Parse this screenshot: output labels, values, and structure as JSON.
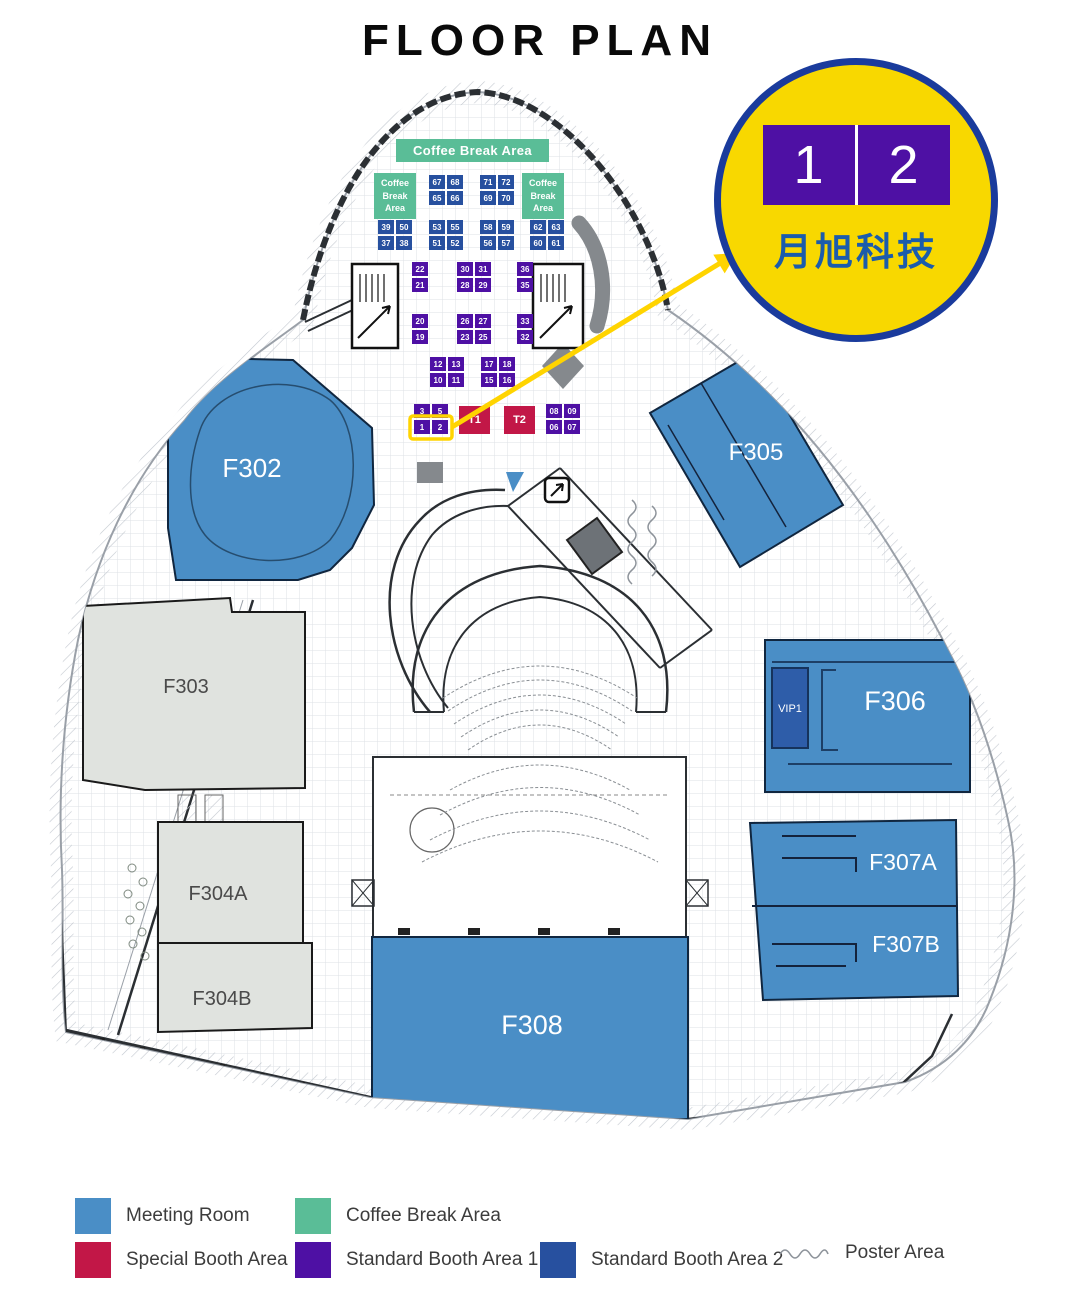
{
  "title": "FLOOR PLAN",
  "badge": {
    "left": "1",
    "right": "2",
    "company": "月旭科技"
  },
  "colors": {
    "meeting": "#4a8ec6",
    "coffee": "#5abd97",
    "special": "#c21747",
    "std1": "#4e10a4",
    "std2": "#27509f",
    "vip": "#2e5da9",
    "room_gray": "#e0e3df",
    "highlight": "#ffd400",
    "badge_bg": "#f8d800",
    "badge_border": "#1a3b9c",
    "badge_text": "#1b5cac",
    "poster": "#8d939a"
  },
  "floor": {
    "coffee_banner": "Coffee Break Area",
    "rooms": {
      "f302": "F302",
      "f303": "F303",
      "f304a": "F304A",
      "f304b": "F304B",
      "f305": "F305",
      "f306": "F306",
      "f307a": "F307A",
      "f307b": "F307B",
      "f308": "F308",
      "vip1": "VIP1"
    },
    "booth_clusters": [
      {
        "name": "cluster-65-68",
        "type": "std2",
        "x": 429,
        "y": 175,
        "rows": [
          [
            "67",
            "68"
          ],
          [
            "65",
            "66"
          ]
        ]
      },
      {
        "name": "cluster-69-72",
        "type": "std2",
        "x": 480,
        "y": 175,
        "rows": [
          [
            "71",
            "72"
          ],
          [
            "69",
            "70"
          ]
        ]
      },
      {
        "name": "coffee-area-left",
        "type": "coffee",
        "x": 374,
        "y": 173,
        "w": 42,
        "h": 46,
        "label": "Coffee Break Area"
      },
      {
        "name": "coffee-area-right",
        "type": "coffee",
        "x": 522,
        "y": 173,
        "w": 42,
        "h": 46,
        "label": "Coffee Break Area"
      },
      {
        "name": "cluster-37-50",
        "type": "std2",
        "x": 378,
        "y": 220,
        "rows": [
          [
            "39",
            "50"
          ],
          [
            "37",
            "38"
          ]
        ]
      },
      {
        "name": "cluster-51-55",
        "type": "std2",
        "x": 429,
        "y": 220,
        "rows": [
          [
            "53",
            "55"
          ],
          [
            "51",
            "52"
          ]
        ]
      },
      {
        "name": "cluster-56-59",
        "type": "std2",
        "x": 480,
        "y": 220,
        "rows": [
          [
            "58",
            "59"
          ],
          [
            "56",
            "57"
          ]
        ]
      },
      {
        "name": "cluster-60-63",
        "type": "std2",
        "x": 530,
        "y": 220,
        "rows": [
          [
            "62",
            "63"
          ],
          [
            "60",
            "61"
          ]
        ]
      },
      {
        "name": "cluster-21-22",
        "type": "std1",
        "x": 412,
        "y": 262,
        "rows": [
          [
            "22"
          ],
          [
            "21"
          ]
        ]
      },
      {
        "name": "cluster-28-31",
        "type": "std1",
        "x": 457,
        "y": 262,
        "rows": [
          [
            "30",
            "31"
          ],
          [
            "28",
            "29"
          ]
        ]
      },
      {
        "name": "cluster-35-36",
        "type": "std1",
        "x": 517,
        "y": 262,
        "rows": [
          [
            "36"
          ],
          [
            "35"
          ]
        ]
      },
      {
        "name": "cluster-19-20",
        "type": "std1",
        "x": 412,
        "y": 314,
        "rows": [
          [
            "20"
          ],
          [
            "19"
          ]
        ]
      },
      {
        "name": "cluster-23-27",
        "type": "std1",
        "x": 457,
        "y": 314,
        "rows": [
          [
            "26",
            "27"
          ],
          [
            "23",
            "25"
          ]
        ]
      },
      {
        "name": "cluster-32-33",
        "type": "std1",
        "x": 517,
        "y": 314,
        "rows": [
          [
            "33"
          ],
          [
            "32"
          ]
        ]
      },
      {
        "name": "cluster-10-13",
        "type": "std1",
        "x": 430,
        "y": 357,
        "rows": [
          [
            "12",
            "13"
          ],
          [
            "10",
            "11"
          ]
        ]
      },
      {
        "name": "cluster-15-18",
        "type": "std1",
        "x": 481,
        "y": 357,
        "rows": [
          [
            "17",
            "18"
          ],
          [
            "15",
            "16"
          ]
        ]
      },
      {
        "name": "cluster-1-5",
        "type": "std1",
        "x": 414,
        "y": 404,
        "rows": [
          [
            "3",
            "5"
          ],
          [
            "1",
            "2"
          ]
        ]
      },
      {
        "name": "booth-T1",
        "type": "special",
        "x": 459,
        "y": 406,
        "w": 31,
        "h": 28,
        "label": "T1"
      },
      {
        "name": "booth-T2",
        "type": "special",
        "x": 504,
        "y": 406,
        "w": 31,
        "h": 28,
        "label": "T2"
      },
      {
        "name": "cluster-06-09",
        "type": "std1",
        "x": 546,
        "y": 404,
        "rows": [
          [
            "08",
            "09"
          ],
          [
            "06",
            "07"
          ]
        ]
      }
    ]
  },
  "legend": {
    "items": [
      {
        "label": "Meeting Room",
        "color": "meeting"
      },
      {
        "label": "Coffee Break Area",
        "color": "coffee"
      },
      {
        "label": "Special Booth Area",
        "color": "special"
      },
      {
        "label": "Standard Booth Area 1",
        "color": "std1"
      },
      {
        "label": "Standard Booth Area 2",
        "color": "std2"
      },
      {
        "label": "Poster Area",
        "color": "poster"
      }
    ]
  }
}
